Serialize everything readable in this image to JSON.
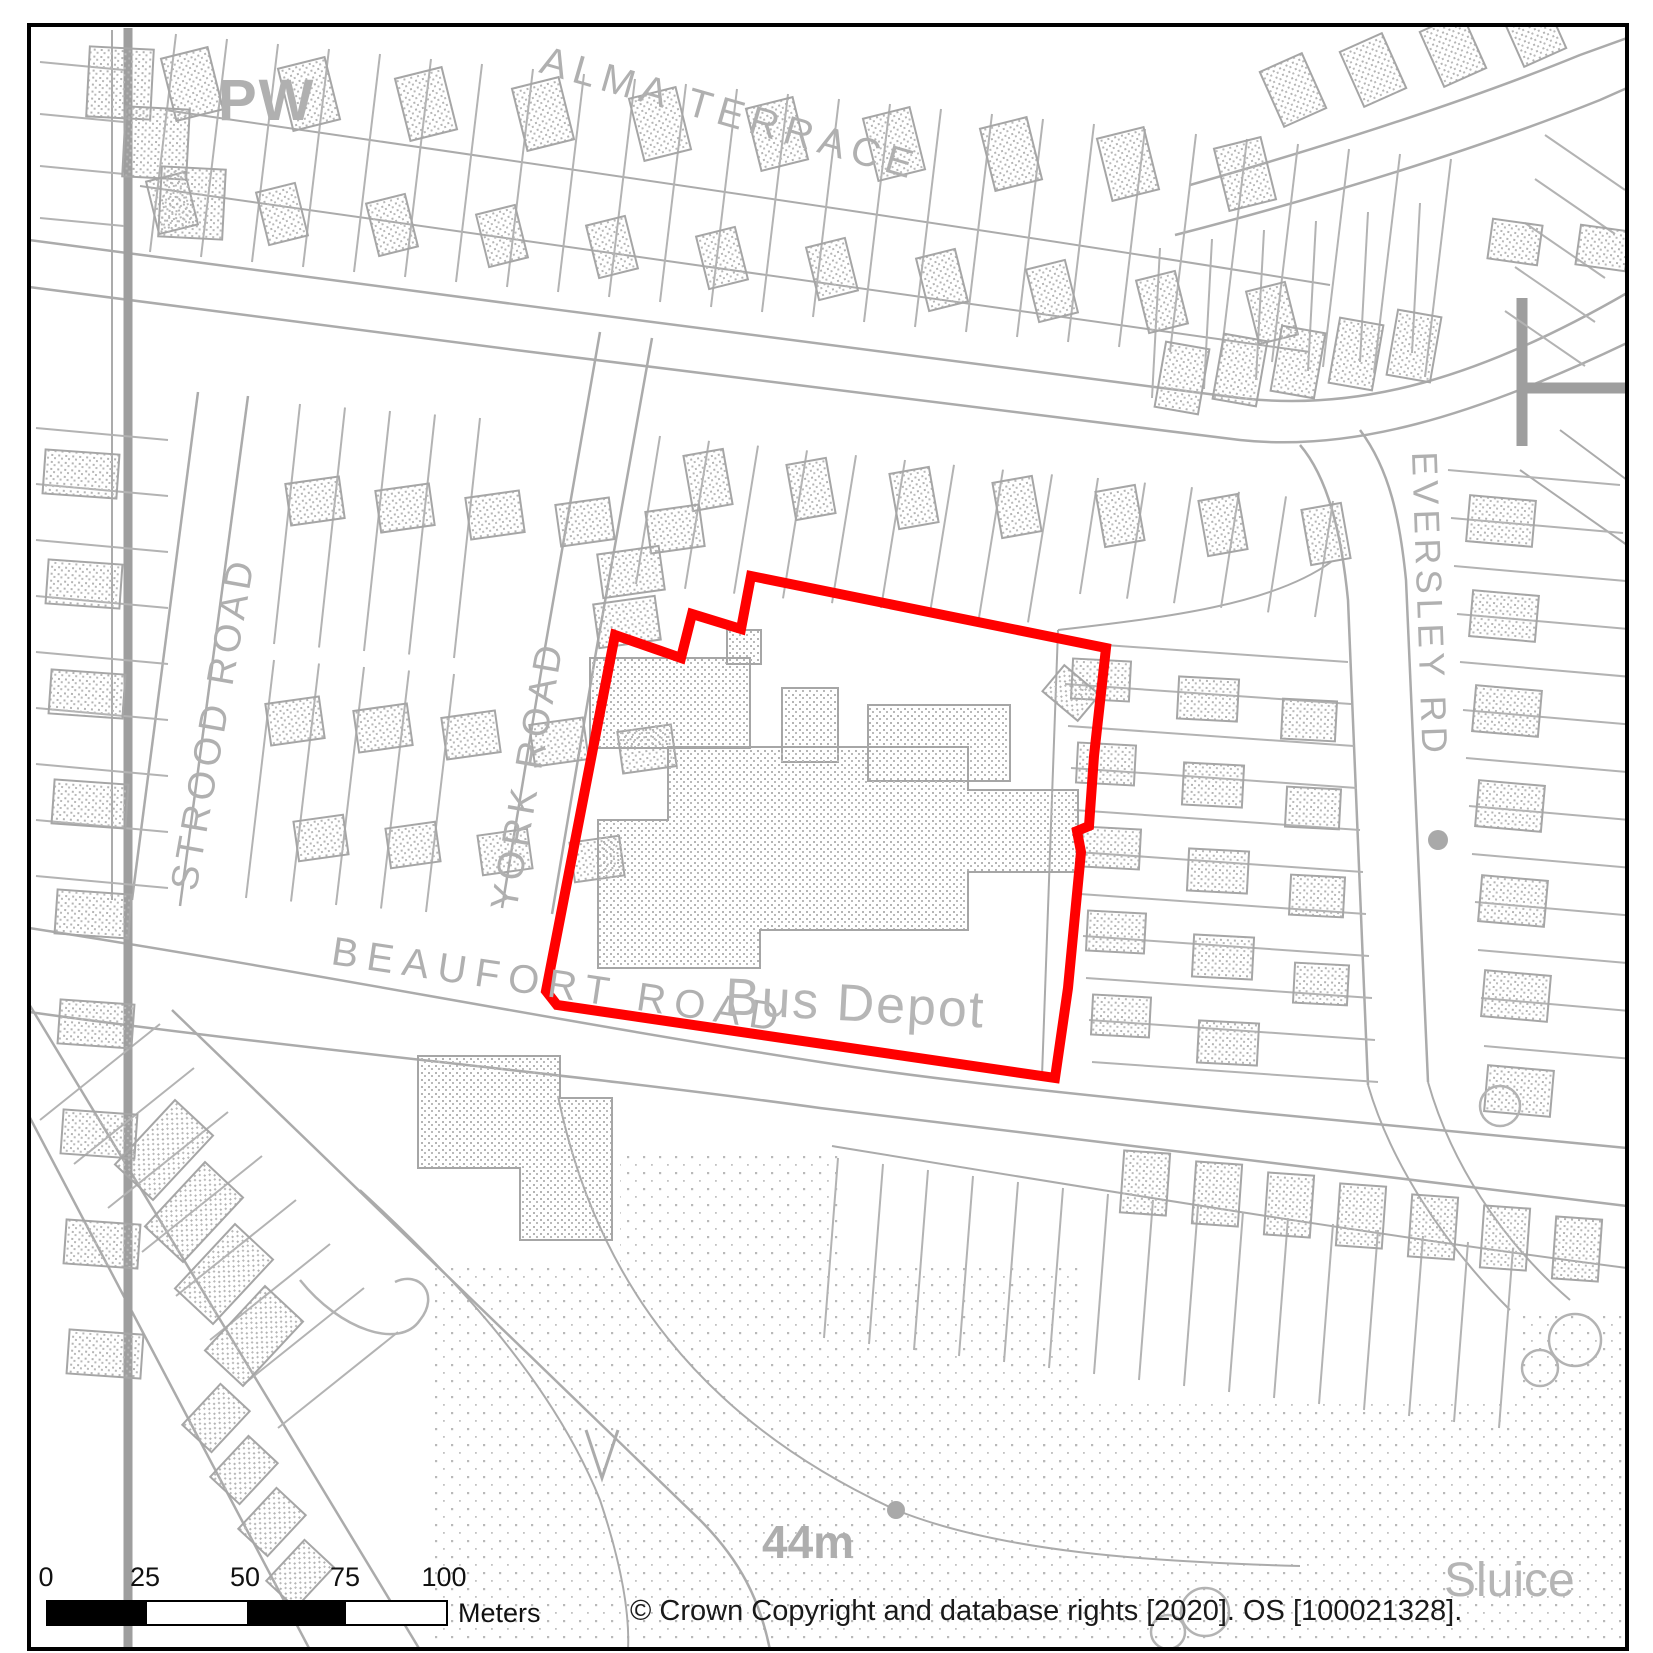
{
  "map": {
    "frame_color": "#000000",
    "line_color": "#ababab",
    "text_color": "#b0b0b0",
    "labels": {
      "pw": "PW",
      "alma_terrace": "ALMA TERRACE",
      "strood_road": "STROOD ROAD",
      "york_road": "YORK ROAD",
      "beaufort_road": "BEAUFORT ROAD",
      "eversley_rd": "EVERSLEY RD",
      "bus_depot": "Bus Depot",
      "spot_height": "44m",
      "sluice": "Sluice"
    },
    "site_boundary": {
      "color": "#ff0000",
      "points": "751,576 1106,648 1094,756 1089,826 1077,831 1081,852 1068,988 1055,1078 557,1005 546,991 615,635 681,658 692,614 741,629"
    }
  },
  "scale_bar": {
    "ticks": [
      "0",
      "25",
      "50",
      "75",
      "100"
    ],
    "unit": "Meters"
  },
  "attribution": "© Crown Copyright and database rights [2020]. OS [100021328]."
}
